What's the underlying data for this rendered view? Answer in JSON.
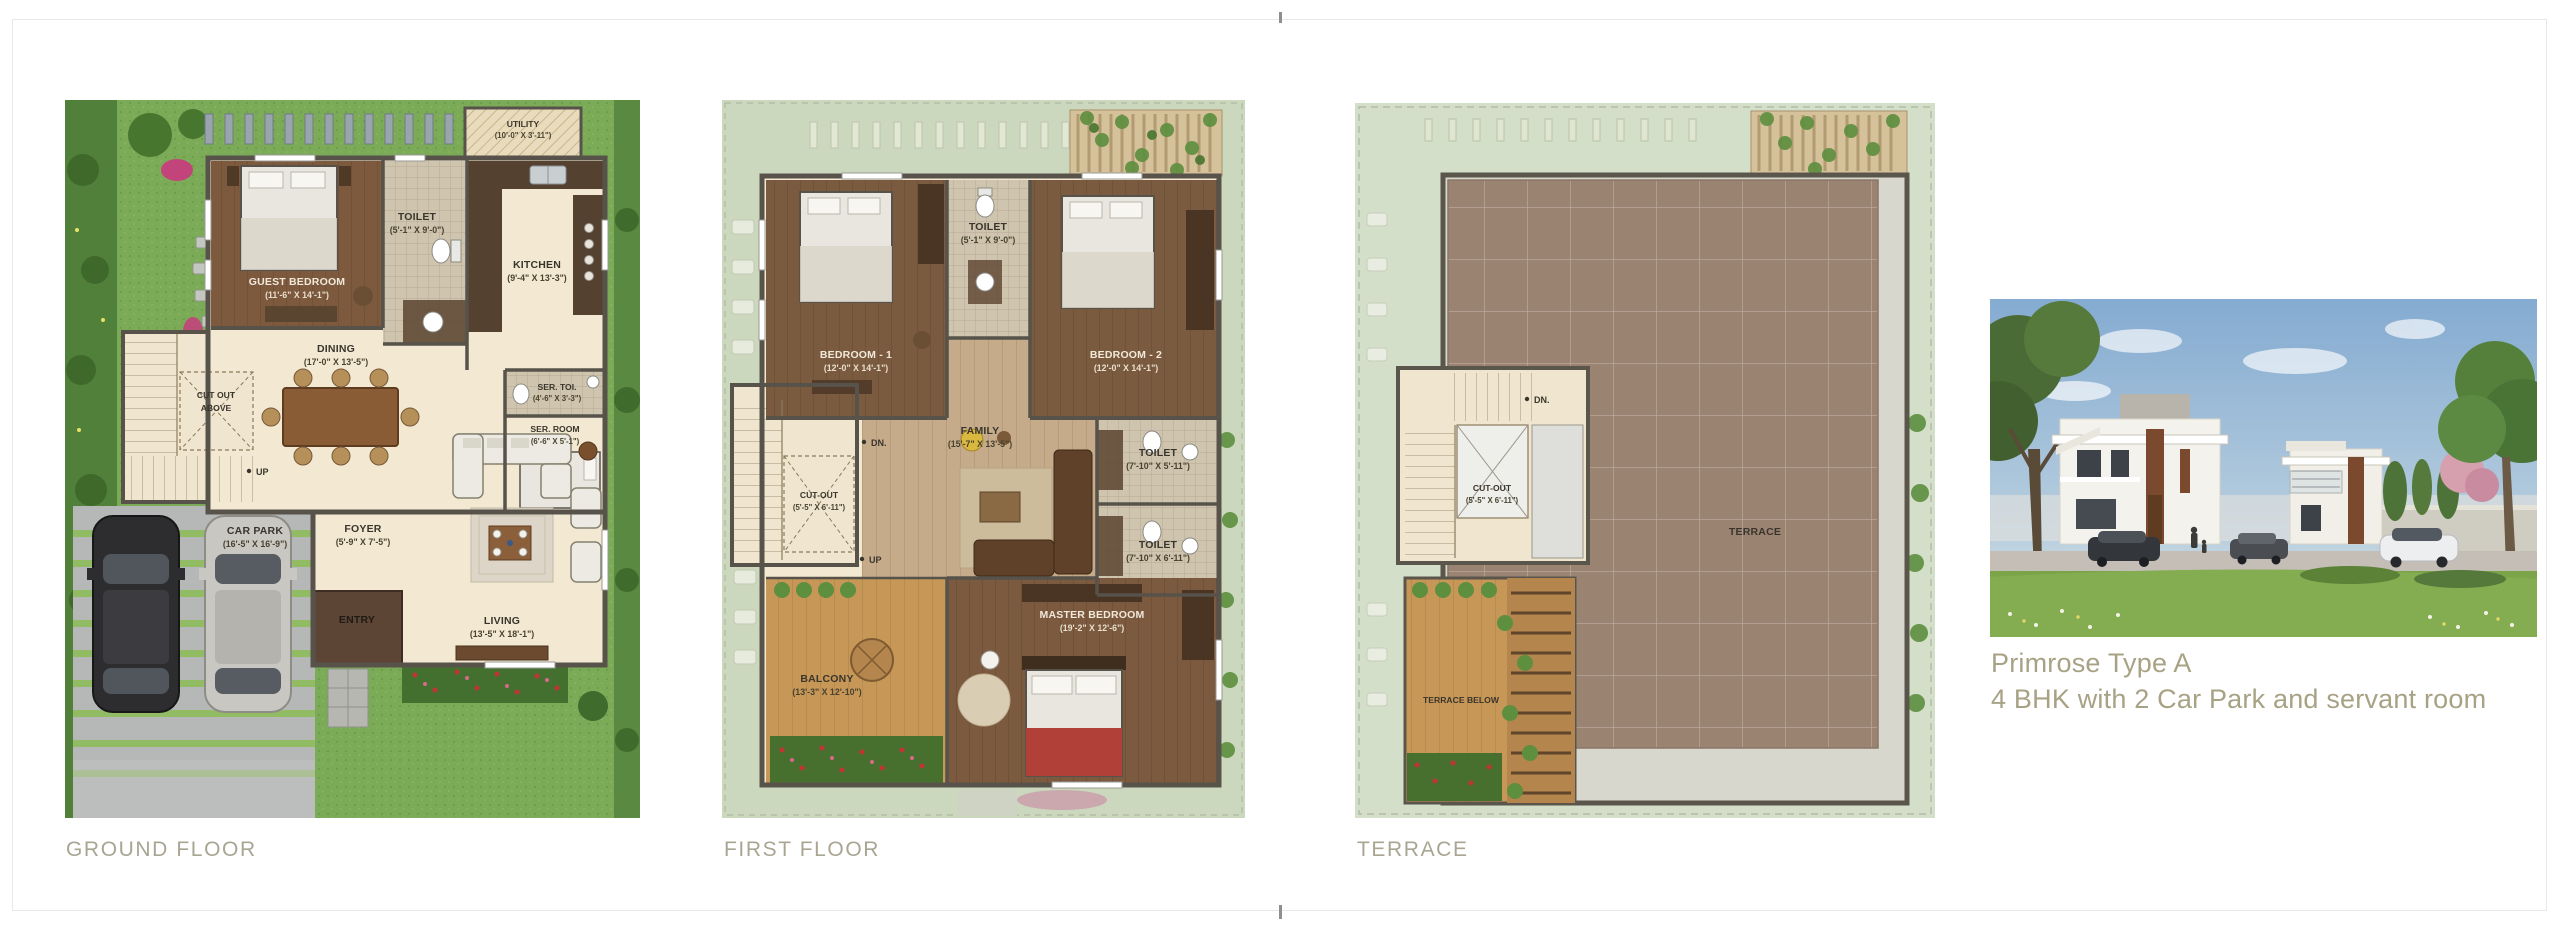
{
  "page": {
    "background": "#ffffff",
    "card_border_color": "#e9e8e5",
    "tick_color": "#8f8f8f",
    "caption_color": "#a9a593",
    "listing_color": "#a8a285"
  },
  "listing": {
    "title": "Primrose Type A",
    "subtitle": "4 BHK with 2 Car Park and servant room"
  },
  "ground_floor": {
    "caption": "GROUND FLOOR",
    "rooms": {
      "utility": {
        "name": "UTILITY",
        "dim": "(10'-0\" X 3'-11\")"
      },
      "toilet": {
        "name": "TOILET",
        "dim": "(5'-1\" X 9'-0\")"
      },
      "guest_bedroom": {
        "name": "GUEST BEDROOM",
        "dim": "(11'-6\" X 14'-1\")"
      },
      "kitchen": {
        "name": "KITCHEN",
        "dim": "(9'-4\" X 13'-3\")"
      },
      "dining": {
        "name": "DINING",
        "dim": "(17'-0\" X 13'-5\")"
      },
      "cut_out": {
        "line1": "CUT OUT",
        "line2": "ABOVE"
      },
      "ser_toi": {
        "name": "SER. TOI.",
        "dim": "(4'-6\" X 3'-3\")"
      },
      "ser_room": {
        "name": "SER. ROOM",
        "dim": "(6'-6\" X 5'-1\")"
      },
      "car_park": {
        "name": "CAR PARK",
        "dim": "(16'-5\" X 16'-9\")"
      },
      "foyer": {
        "name": "FOYER",
        "dim": "(5'-9\" X 7'-5\")"
      },
      "entry": {
        "name": "ENTRY"
      },
      "living": {
        "name": "LIVING",
        "dim": "(13'-5\" X 18'-1\")"
      },
      "up": "UP"
    }
  },
  "first_floor": {
    "caption": "FIRST FLOOR",
    "rooms": {
      "bedroom1": {
        "name": "BEDROOM - 1",
        "dim": "(12'-0\" X 14'-1\")"
      },
      "toilet_top": {
        "name": "TOILET",
        "dim": "(5'-1\" X 9'-0\")"
      },
      "bedroom2": {
        "name": "BEDROOM - 2",
        "dim": "(12'-0\" X 14'-1\")"
      },
      "family": {
        "name": "FAMILY",
        "dim": "(15'-7\" X 13'-5\")"
      },
      "cut_out": {
        "name": "CUT-OUT",
        "dim": "(5'-5\" X 6'-11\")"
      },
      "toilet_mid": {
        "name": "TOILET",
        "dim": "(7'-10\" X 5'-11\")"
      },
      "toilet_bottom": {
        "name": "TOILET",
        "dim": "(7'-10\" X 6'-11\")"
      },
      "master_bedroom": {
        "name": "MASTER BEDROOM",
        "dim": "(19'-2\" X 12'-6\")"
      },
      "balcony": {
        "name": "BALCONY",
        "dim": "(13'-3\" X 12'-10\")"
      },
      "dn": "DN.",
      "up": "UP"
    }
  },
  "terrace_floor": {
    "caption": "TERRACE",
    "rooms": {
      "terrace": {
        "name": "TERRACE"
      },
      "cut_out": {
        "name": "CUT-OUT",
        "dim": "(5'-5\" X 6'-11\")"
      },
      "terrace_below": {
        "name": "TERRACE BELOW"
      },
      "dn": "DN."
    }
  }
}
